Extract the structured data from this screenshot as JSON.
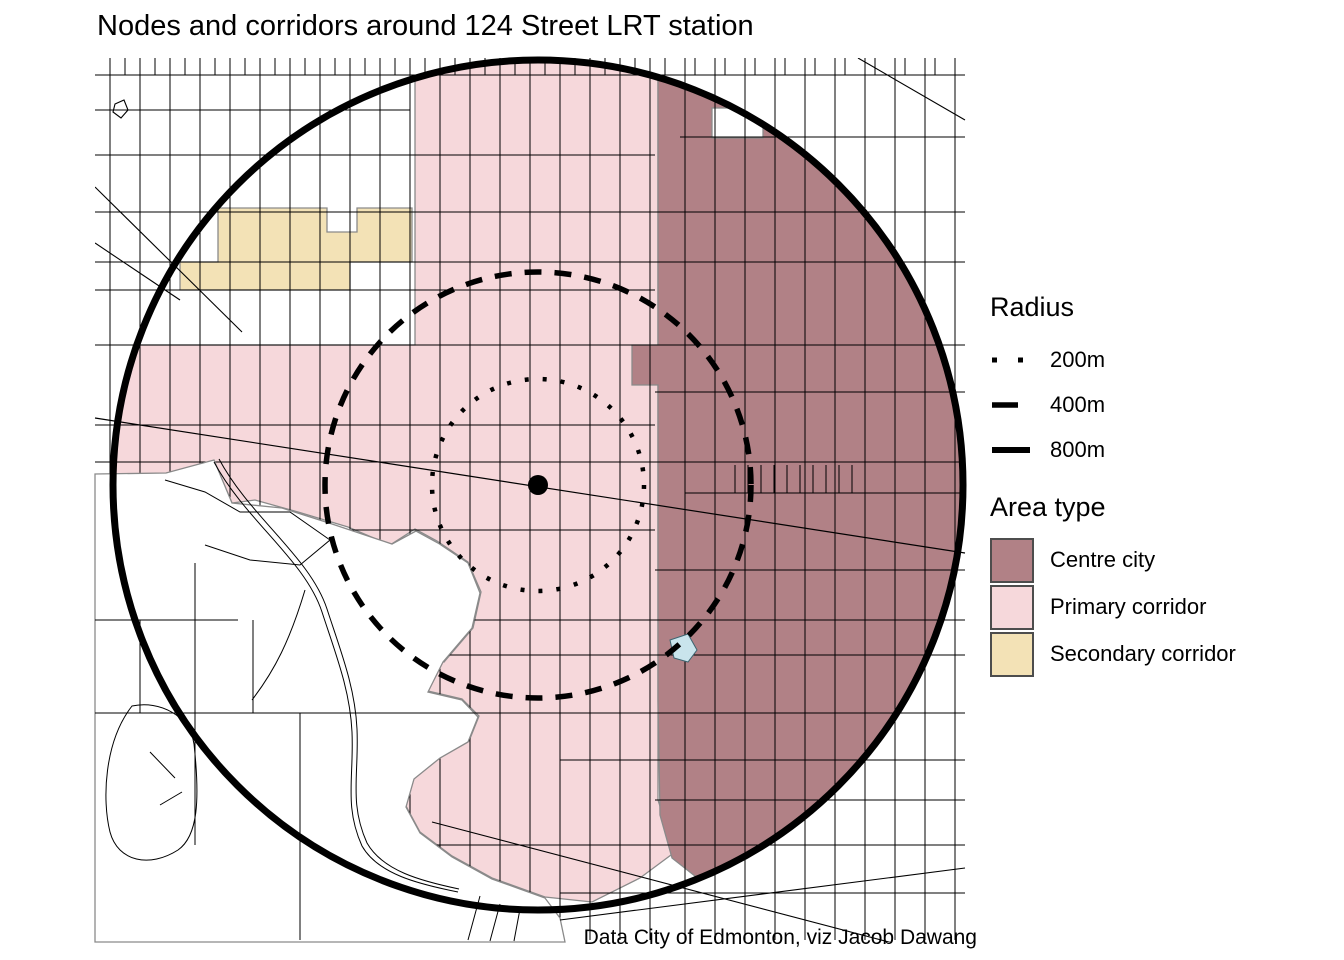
{
  "title": "Nodes and corridors around 124 Street LRT station",
  "caption": "Data City of Edmonton, viz Jacob Dawang",
  "legend_radius": {
    "title": "Radius",
    "items": [
      {
        "label": "200m",
        "line_style": "dotted"
      },
      {
        "label": "400m",
        "line_style": "dashed"
      },
      {
        "label": "800m",
        "line_style": "solid"
      }
    ]
  },
  "legend_area_type": {
    "title": "Area type",
    "items": [
      {
        "label": "Centre city",
        "color": "#b18186"
      },
      {
        "label": "Primary corridor",
        "color": "#f6d8db"
      },
      {
        "label": "Secondary corridor",
        "color": "#f3e2b6"
      }
    ]
  },
  "map": {
    "rings_m": [
      200,
      400,
      800
    ],
    "colors": {
      "centre_city": "#b18186",
      "primary_corridor": "#f6d8db",
      "secondary_corridor": "#f3e2b6",
      "water": "#c9e4ec",
      "street": "#000000",
      "region_border": "#8a8a8a",
      "background": "#ffffff"
    }
  }
}
